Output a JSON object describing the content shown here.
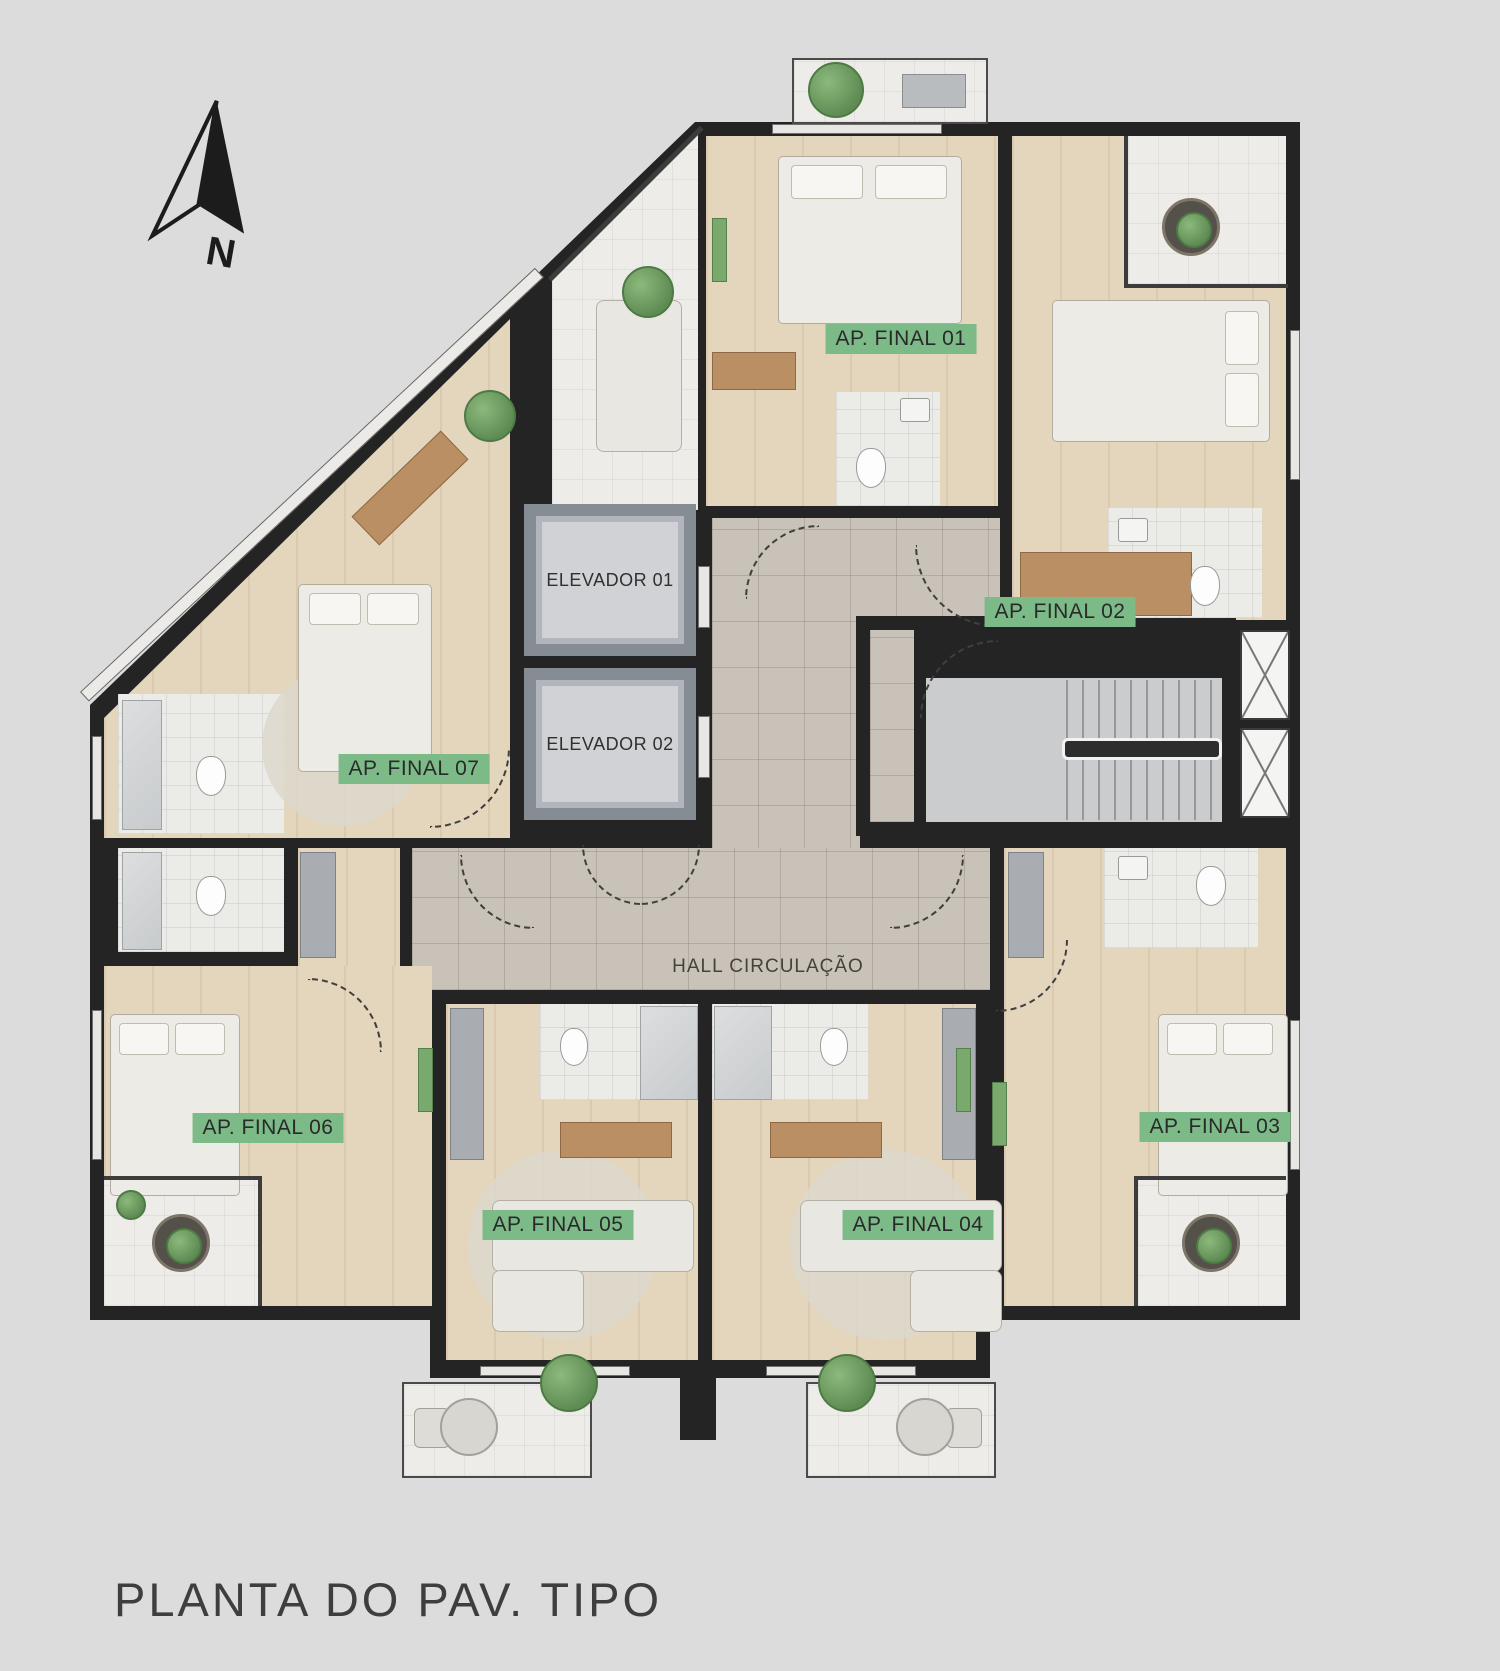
{
  "title": "PLANTA DO PAV. TIPO",
  "north_arrow": {
    "label": "N"
  },
  "hall": {
    "label": "HALL CIRCULAÇÃO"
  },
  "elevators": [
    {
      "label": "ELEVADOR 01"
    },
    {
      "label": "ELEVADOR 02"
    }
  ],
  "apartments": [
    {
      "label": "AP. FINAL 01"
    },
    {
      "label": "AP. FINAL 02"
    },
    {
      "label": "AP. FINAL 03"
    },
    {
      "label": "AP. FINAL 04"
    },
    {
      "label": "AP. FINAL 05"
    },
    {
      "label": "AP. FINAL 06"
    },
    {
      "label": "AP. FINAL 07"
    }
  ],
  "colors": {
    "background": "#dcdcdc",
    "walls": "#242424",
    "wood_floor": "#e4d5bd",
    "hall_tile": "#c9c2b9",
    "bathroom": "#ebebe8",
    "balcony": "#edece8",
    "elevator_shaft": "#868c94",
    "elevator_cab": "#d0d2d5",
    "stair_concrete": "#cbccce",
    "apartment_label_green": "#7cba88",
    "plant_green": "#6f9d62"
  }
}
